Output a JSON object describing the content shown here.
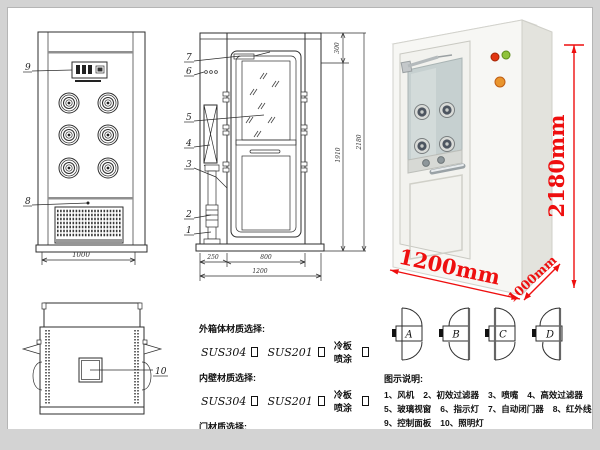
{
  "front_view": {
    "callout_panel": "9",
    "callout_grille": "8",
    "width_dim": "1000"
  },
  "side_view": {
    "callouts": [
      "7",
      "6",
      "5",
      "4",
      "3",
      "2",
      "1"
    ],
    "dim_top": "300",
    "dim_door_height": "1910",
    "dim_total_height": "2180",
    "dim_left_unit": "250",
    "dim_door_width": "800",
    "dim_total_width": "1200"
  },
  "top_view": {
    "callout_light": "10"
  },
  "photo": {
    "dim_height": "2180mm",
    "dim_width": "1200mm",
    "dim_depth": "1000mm",
    "accent_color": "#ee0f0f"
  },
  "materials": {
    "groups": [
      {
        "label": "外箱体材质选择:",
        "options": [
          "SUS304",
          "SUS201",
          "冷板喷涂"
        ]
      },
      {
        "label": "内壁材质选择:",
        "options": [
          "SUS304",
          "SUS201",
          "冷板喷涂"
        ]
      },
      {
        "label": "门材质选择:",
        "options": [
          "SUS304",
          "SUS201",
          "冷板喷涂"
        ]
      }
    ]
  },
  "door_options": {
    "labels": [
      "A",
      "B",
      "C",
      "D"
    ]
  },
  "legend": {
    "title": "图示说明:",
    "rows": [
      [
        "1、风机",
        "2、初效过滤器",
        "3、喷嘴",
        "4、高效过滤器"
      ],
      [
        "5、玻璃视窗",
        "6、指示灯",
        "7、自动闭门器",
        "8、红外线感应器"
      ],
      [
        "9、控制面板",
        "10、照明灯"
      ]
    ]
  }
}
